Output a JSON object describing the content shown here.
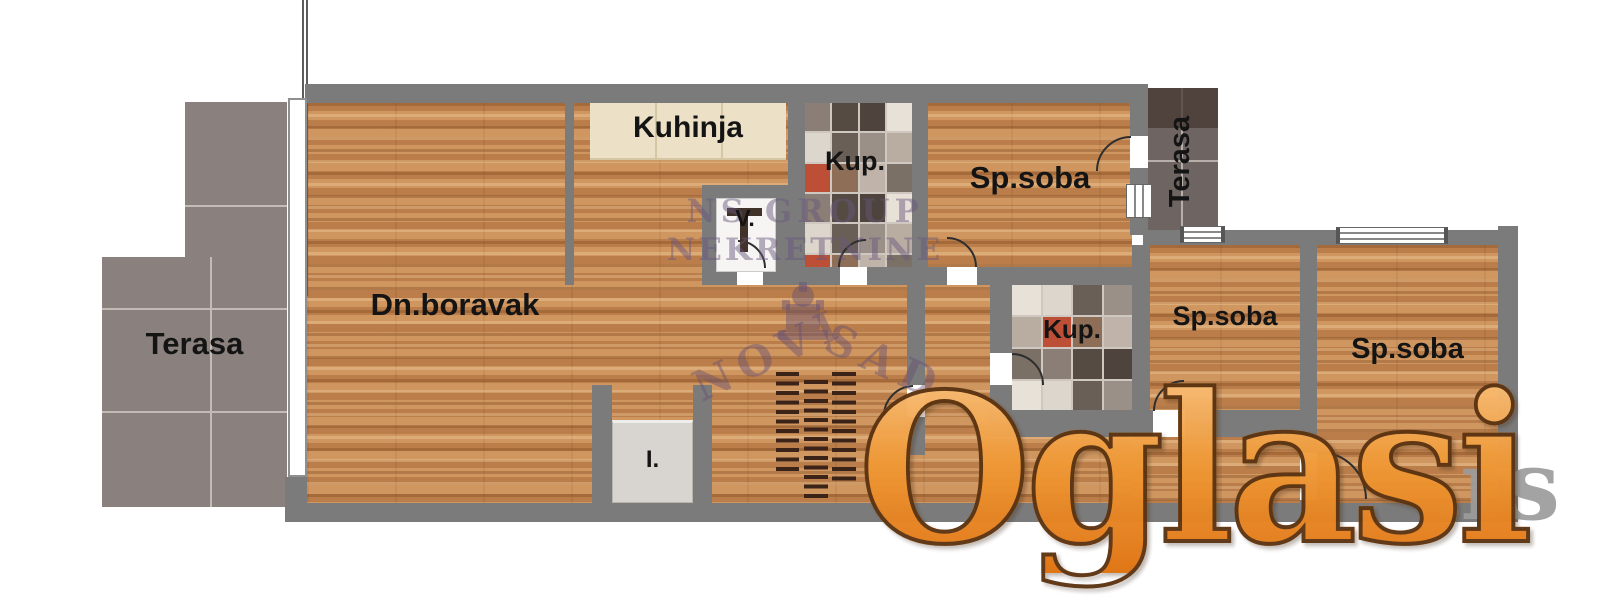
{
  "rooms": {
    "terrace_left": "Terasa",
    "living": "Dn.boravak",
    "kitchen": "Kuhinja",
    "bath1": "Kup.",
    "bedroom1": "Sp.soba",
    "terrace_right": "Terasa",
    "vestibule": "V.",
    "bath2": "Kup.",
    "bedroom2": "Sp.soba",
    "bedroom3": "Sp.soba",
    "storage": "I."
  },
  "watermarks": {
    "agency_line1": "NS GROUP",
    "agency_line2": "NEKRETNINE",
    "agency_city_left": "NOVI",
    "agency_city_right": "SAD",
    "brand": "Oglasi",
    "brand_tld": ".rs"
  },
  "colors": {
    "wall": "#7b7b7b",
    "wood_base": "#c88d58",
    "terrace_left_tile": "#8a817e",
    "terrace_right_tile": "#6e6461",
    "kitchen_counter": "#ece0c6",
    "storage_floor": "#d8d5d0",
    "stair_stroke": "#3b2417",
    "brand_orange": "#ef8c28",
    "brand_tld_gray": "#9c9c9c",
    "mosaic_palette": [
      "#8a7e76",
      "#6a5f57",
      "#c0b4aa",
      "#e8e1d8",
      "#bd4f36",
      "#554b43",
      "#9b9088",
      "#7b7066",
      "#ddd6cc",
      "#8f6e58",
      "#4e443d",
      "#b9ada2"
    ]
  }
}
